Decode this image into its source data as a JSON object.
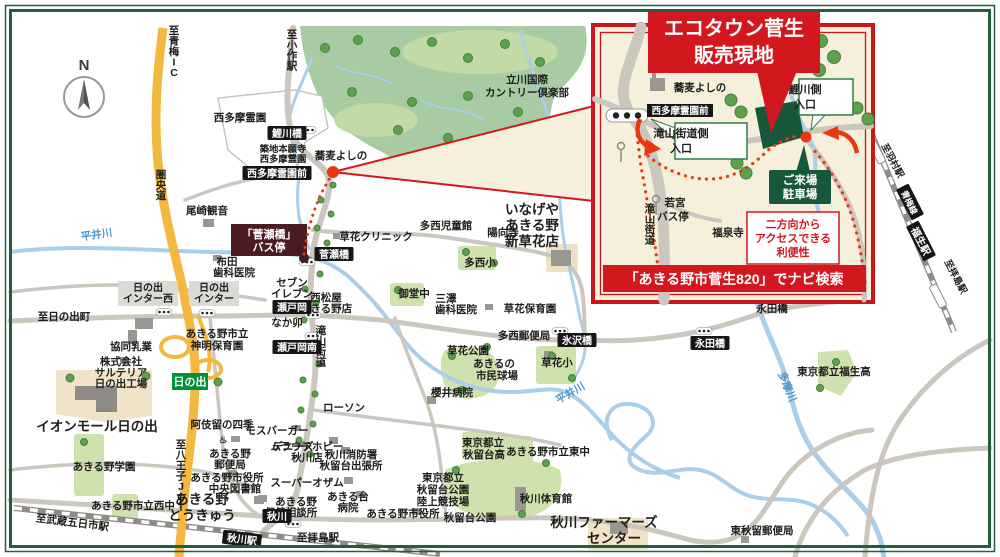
{
  "colors": {
    "accent_red": "#d3171e",
    "route_red": "#e8380d",
    "site_green": "#17573a",
    "frame_green": "#215e3e",
    "expressway_yellow": "#f3b83f",
    "ic_green": "#00913a",
    "busstop_maroon": "#4a1c22",
    "river_blue": "#a9cfea",
    "road_gray": "#cbc7bf"
  },
  "compass": {
    "north": "N"
  },
  "inset": {
    "title1": "エコタウン菅生",
    "title2": "販売現地",
    "banner": "「あきる野市菅生820」でナビ検索",
    "access1": "二方向から",
    "access2": "アクセスできる",
    "access3": "利便性",
    "parking1": "ご来場",
    "parking2": "駐車場",
    "ent_west1": "滝山街道側",
    "ent_west2": "入口",
    "ent_east1": "鯉川側",
    "ent_east2": "入口",
    "bus_badge": "西多摩霊園前"
  },
  "inset_labels": [
    {
      "t": "蕎麦よしの",
      "x": 700,
      "y": 91
    },
    {
      "t": "滝山街道",
      "x": 650,
      "y": 212,
      "c": "vert"
    },
    {
      "t": "若宮",
      "x": 675,
      "y": 206
    },
    {
      "t": "バス停",
      "x": 673,
      "y": 220
    },
    {
      "t": "福泉寺",
      "x": 728,
      "y": 236
    }
  ],
  "busstop_box": {
    "line1": "「菅瀬橋」",
    "line2": "バス停"
  },
  "interchanges": {
    "west": {
      "line1": "日の出",
      "line2": "インター西"
    },
    "main": {
      "line1": "日の出",
      "line2": "インター"
    },
    "ic_badge": "日の出"
  },
  "labels": [
    {
      "t": "西多摩霊園",
      "x": 240,
      "y": 121
    },
    {
      "t": "築地本願寺",
      "x": 283,
      "y": 152,
      "c": "s"
    },
    {
      "t": "西多摩霊園",
      "x": 283,
      "y": 162,
      "c": "s"
    },
    {
      "t": "蕎麦よしの",
      "x": 341,
      "y": 159
    },
    {
      "t": "立川国際",
      "x": 527,
      "y": 83
    },
    {
      "t": "カントリー倶楽部",
      "x": 527,
      "y": 96
    },
    {
      "t": "至小作駅",
      "x": 292,
      "y": 38,
      "c": "vert"
    },
    {
      "t": "至青梅IC",
      "x": 174,
      "y": 34,
      "c": "vert"
    },
    {
      "t": "圏央道",
      "x": 161,
      "y": 178,
      "c": "vert"
    },
    {
      "t": "尾崎観音",
      "x": 207,
      "y": 214
    },
    {
      "t": "平井川",
      "x": 97,
      "y": 238,
      "c": "riv",
      "r": -8
    },
    {
      "t": "布田",
      "x": 227,
      "y": 265
    },
    {
      "t": "歯科医院",
      "x": 234,
      "y": 276
    },
    {
      "t": "草花クリニック",
      "x": 376,
      "y": 240
    },
    {
      "t": "多西児童館",
      "x": 446,
      "y": 229
    },
    {
      "t": "陽向寺",
      "x": 503,
      "y": 236
    },
    {
      "t": "いなげや",
      "x": 532,
      "y": 214,
      "c": "lg",
      "a": "start"
    },
    {
      "t": "あきる野",
      "x": 532,
      "y": 230,
      "c": "lg",
      "a": "start"
    },
    {
      "t": "新草花店",
      "x": 532,
      "y": 246,
      "c": "lg",
      "a": "start"
    },
    {
      "t": "多西小",
      "x": 480,
      "y": 266
    },
    {
      "t": "御堂中",
      "x": 414,
      "y": 297
    },
    {
      "t": "三澤",
      "x": 446,
      "y": 302
    },
    {
      "t": "歯科医院",
      "x": 456,
      "y": 313
    },
    {
      "t": "草花保育園",
      "x": 530,
      "y": 312
    },
    {
      "t": "多西郵便局",
      "x": 524,
      "y": 339
    },
    {
      "t": "草花公園",
      "x": 468,
      "y": 354
    },
    {
      "t": "あきるの",
      "x": 494,
      "y": 367
    },
    {
      "t": "市民球場",
      "x": 497,
      "y": 379
    },
    {
      "t": "草花小",
      "x": 557,
      "y": 366
    },
    {
      "t": "平井川",
      "x": 572,
      "y": 396,
      "c": "riv",
      "r": -30
    },
    {
      "t": "櫻井病院",
      "x": 452,
      "y": 396
    },
    {
      "t": "セブン",
      "x": 292,
      "y": 286
    },
    {
      "t": "イレブン",
      "x": 292,
      "y": 297
    },
    {
      "t": "西松屋",
      "x": 326,
      "y": 301,
      "a": "start"
    },
    {
      "t": "あきる野店",
      "x": 326,
      "y": 312,
      "a": "start"
    },
    {
      "t": "なか卯",
      "x": 287,
      "y": 326
    },
    {
      "t": "滝山街道",
      "x": 321,
      "y": 334,
      "c": "vert"
    },
    {
      "t": "至日の出町",
      "x": 64,
      "y": 320
    },
    {
      "t": "協同乳業",
      "x": 131,
      "y": 350
    },
    {
      "t": "株式会社",
      "x": 121,
      "y": 365,
      "a": "start"
    },
    {
      "t": "サルテリア",
      "x": 121,
      "y": 376,
      "a": "start"
    },
    {
      "t": "日の出工場",
      "x": 121,
      "y": 387,
      "a": "start"
    },
    {
      "t": "あきる野市立",
      "x": 217,
      "y": 337,
      "a": "start"
    },
    {
      "t": "神明保育園",
      "x": 217,
      "y": 349,
      "a": "start"
    },
    {
      "t": "ローソン",
      "x": 344,
      "y": 411
    },
    {
      "t": "モスバーガー",
      "x": 277,
      "y": 434
    },
    {
      "t": "デニーズ",
      "x": 293,
      "y": 450
    },
    {
      "t": "ムラウチホビー",
      "x": 307,
      "y": 450,
      "a": "start"
    },
    {
      "t": "秋川店",
      "x": 307,
      "y": 461,
      "a": "start"
    },
    {
      "t": "秋川消防署",
      "x": 351,
      "y": 458,
      "a": "start"
    },
    {
      "t": "秋留台出張所",
      "x": 351,
      "y": 469,
      "a": "start"
    },
    {
      "t": "スーパーオザム",
      "x": 307,
      "y": 486,
      "a": "start"
    },
    {
      "t": "あきる野",
      "x": 230,
      "y": 457,
      "a": "start"
    },
    {
      "t": "郵便局",
      "x": 230,
      "y": 468,
      "a": "start"
    },
    {
      "t": "あきる野市役所",
      "x": 227,
      "y": 481,
      "a": "start"
    },
    {
      "t": "中央図書館",
      "x": 235,
      "y": 492,
      "a": "start"
    },
    {
      "t": "阿伎留の四季",
      "x": 222,
      "y": 428
    },
    {
      "t": "♨",
      "x": 223,
      "y": 443,
      "c": "s"
    },
    {
      "t": "あきる野",
      "x": 202,
      "y": 504,
      "c": "lg",
      "a": "start"
    },
    {
      "t": "とうきゅう",
      "x": 202,
      "y": 520,
      "c": "lg",
      "a": "start"
    },
    {
      "t": "あきる野",
      "x": 296,
      "y": 505,
      "a": "start"
    },
    {
      "t": "保健相談所",
      "x": 291,
      "y": 516,
      "a": "start"
    },
    {
      "t": "あきる台",
      "x": 348,
      "y": 500,
      "a": "start"
    },
    {
      "t": "病院",
      "x": 348,
      "y": 511,
      "a": "start"
    },
    {
      "t": "あきる野市役所",
      "x": 403,
      "y": 517
    },
    {
      "t": "東京都立",
      "x": 483,
      "y": 446
    },
    {
      "t": "秋留台高",
      "x": 484,
      "y": 458
    },
    {
      "t": "あきる野市立東中",
      "x": 548,
      "y": 455
    },
    {
      "t": "東京都立",
      "x": 443,
      "y": 481,
      "a": "start"
    },
    {
      "t": "秋留台公園",
      "x": 443,
      "y": 493,
      "a": "start"
    },
    {
      "t": "陸上競技場",
      "x": 443,
      "y": 505,
      "a": "start"
    },
    {
      "t": "秋留台公園",
      "x": 470,
      "y": 521
    },
    {
      "t": "秋川体育館",
      "x": 546,
      "y": 502
    },
    {
      "t": "イオンモール日の出",
      "x": 97,
      "y": 431,
      "c": "lg"
    },
    {
      "t": "あきる野学園",
      "x": 104,
      "y": 470
    },
    {
      "t": "あきる野市立西中",
      "x": 133,
      "y": 509
    },
    {
      "t": "至八王子JCT",
      "x": 181,
      "y": 448,
      "c": "vert"
    },
    {
      "t": "至武蔵五日市駅",
      "x": 72,
      "y": 526,
      "r": 7
    },
    {
      "t": "至拝島駅",
      "x": 318,
      "y": 541
    },
    {
      "t": "秋川ファーマーズ",
      "x": 604,
      "y": 527,
      "c": "lg",
      "a": "start"
    },
    {
      "t": "センター",
      "x": 614,
      "y": 543,
      "c": "lg",
      "a": "start"
    },
    {
      "t": "東秋留郵便局",
      "x": 762,
      "y": 534
    },
    {
      "t": "東京都立福生高",
      "x": 834,
      "y": 375
    },
    {
      "t": "永田橋",
      "x": 772,
      "y": 312
    },
    {
      "t": "多摩川",
      "x": 784,
      "y": 388,
      "c": "riv",
      "r": 68
    },
    {
      "t": "至羽村駅",
      "x": 890,
      "y": 162,
      "c": "s",
      "r": 62
    },
    {
      "t": "至拝島駅",
      "x": 953,
      "y": 278,
      "c": "s",
      "r": 62
    }
  ],
  "badges": [
    {
      "t": "鯉川橋",
      "x": 287,
      "y": 133
    },
    {
      "t": "西多摩霊園前",
      "x": 277,
      "y": 173
    },
    {
      "t": "菅瀬橋",
      "x": 334,
      "y": 254
    },
    {
      "t": "瀬戸岡",
      "x": 292,
      "y": 307
    },
    {
      "t": "瀬戸岡南",
      "x": 297,
      "y": 347
    },
    {
      "t": "氷沢橋",
      "x": 577,
      "y": 340
    },
    {
      "t": "永田橋",
      "x": 710,
      "y": 343
    },
    {
      "t": "秋川",
      "x": 277,
      "y": 516
    },
    {
      "t": "秋川駅",
      "x": 242,
      "y": 539,
      "r": 7
    },
    {
      "t": "福生駅",
      "x": 921,
      "y": 241,
      "r": 63
    },
    {
      "t": "青梅線",
      "x": 910,
      "y": 202,
      "r": 63,
      "fs": 8.5
    }
  ],
  "signals": [
    [
      308,
      130
    ],
    [
      164,
      312
    ],
    [
      207,
      313
    ],
    [
      313,
      315
    ],
    [
      313,
      336
    ],
    [
      307,
      262
    ],
    [
      560,
      331
    ],
    [
      704,
      331
    ],
    [
      293,
      524
    ]
  ]
}
